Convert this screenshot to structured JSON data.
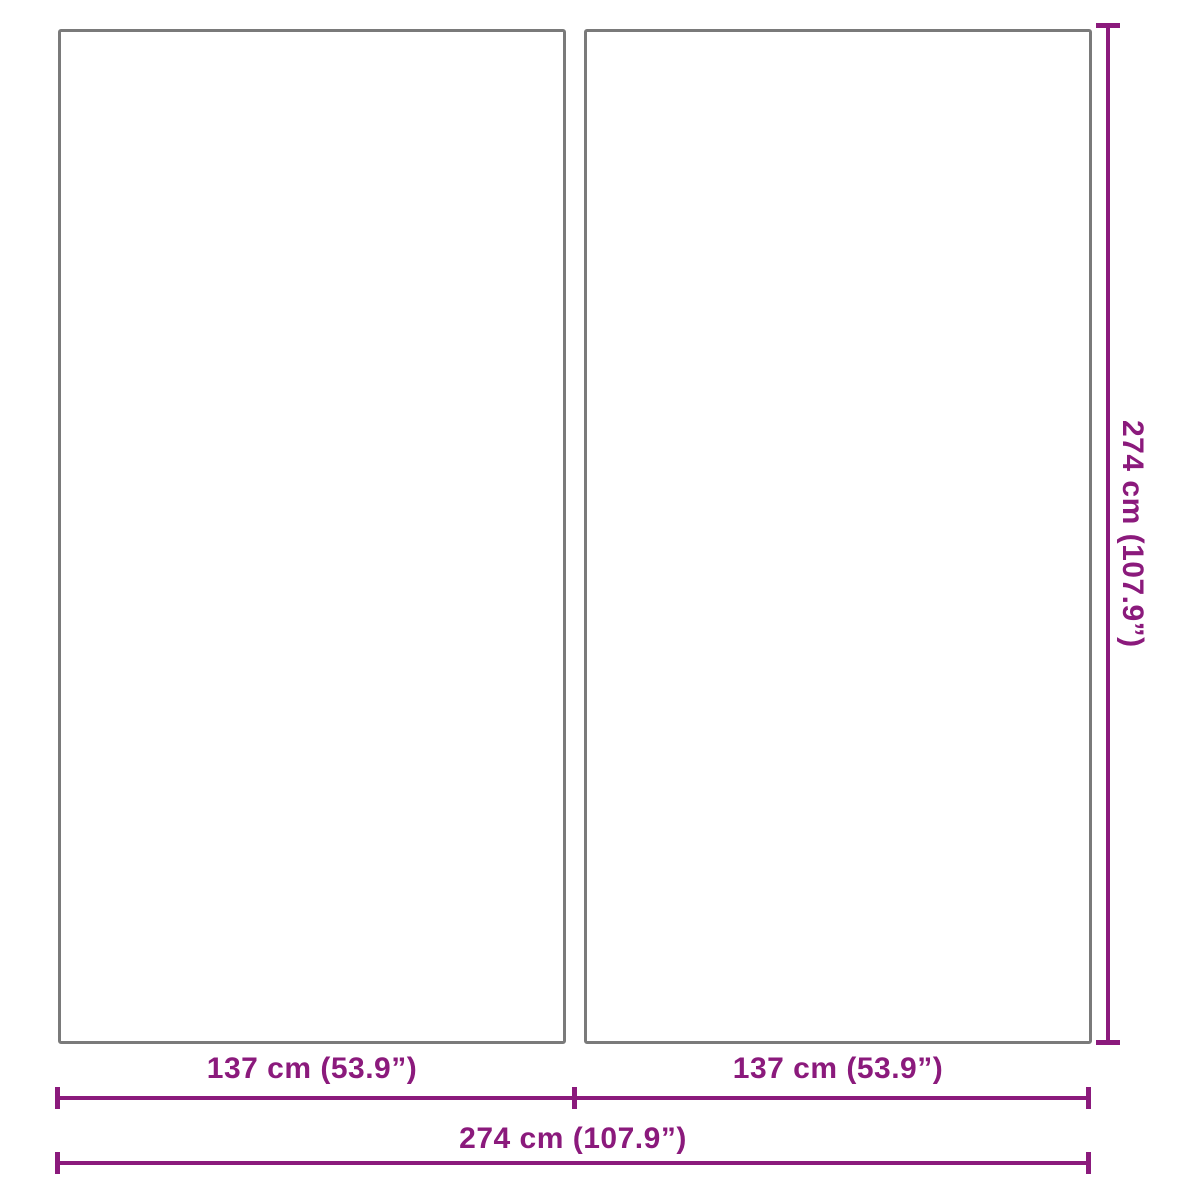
{
  "diagram": {
    "type": "product-dimension-diagram",
    "panels": [
      {
        "name": "left-panel",
        "width_label": "137 cm (53.9”)",
        "height_label": "274 cm (107.9”)"
      },
      {
        "name": "right-panel",
        "width_label": "137 cm (53.9”)",
        "height_label": "274 cm (107.9”)"
      }
    ],
    "dimensions": {
      "height_right": {
        "label": "274 cm (107.9”)",
        "value_cm": 274,
        "value_in": 107.9,
        "orientation": "vertical"
      },
      "width_left_half": {
        "label": "137 cm (53.9”)",
        "value_cm": 137,
        "value_in": 53.9,
        "orientation": "horizontal"
      },
      "width_right_half": {
        "label": "137 cm (53.9”)",
        "value_cm": 137,
        "value_in": 53.9,
        "orientation": "horizontal"
      },
      "width_total": {
        "label": "274 cm (107.9”)",
        "value_cm": 274,
        "value_in": 107.9,
        "orientation": "horizontal"
      }
    },
    "colors": {
      "dimension_accent": "#8b1a7c",
      "panel_border": "#7a7a7a",
      "background": "#ffffff"
    }
  }
}
